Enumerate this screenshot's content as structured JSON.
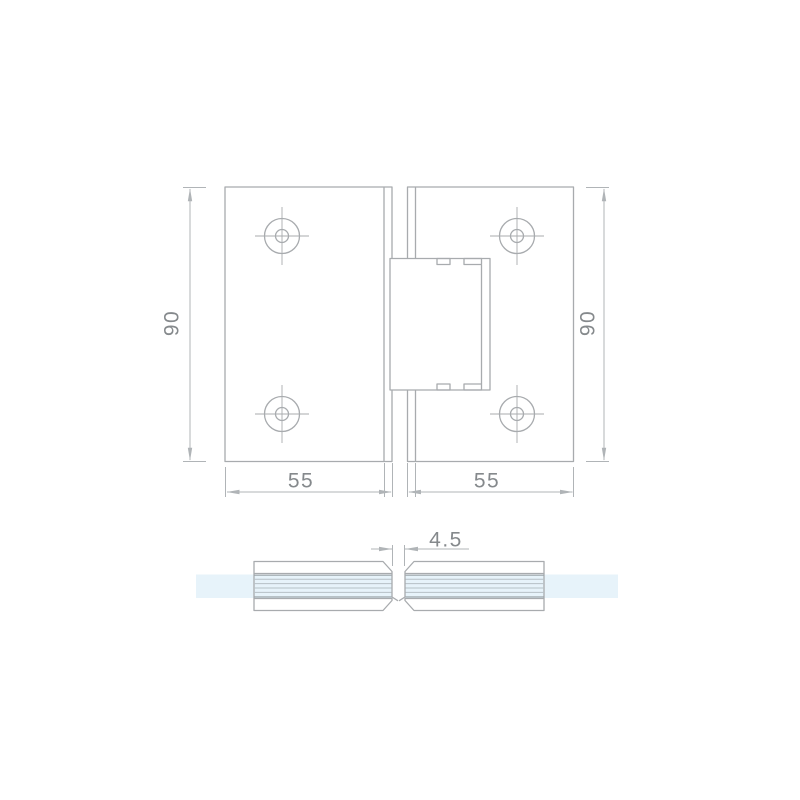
{
  "drawing_type": "glass-door-hinge-technical-drawing",
  "front_view": {
    "dim_height_left": "90",
    "dim_height_right": "90",
    "dim_width_left": "55",
    "dim_width_right": "55"
  },
  "section_view": {
    "dim_gap": "4.5"
  },
  "colors": {
    "object_line": "#a8abae",
    "dimension_line": "#b0b4b7",
    "dimension_text": "#85898c",
    "glass_fill": "#e7f3fa",
    "gasket_line_light": "#b6c0c6",
    "gasket_line_dark": "#9aa3a8",
    "background": "#ffffff"
  }
}
